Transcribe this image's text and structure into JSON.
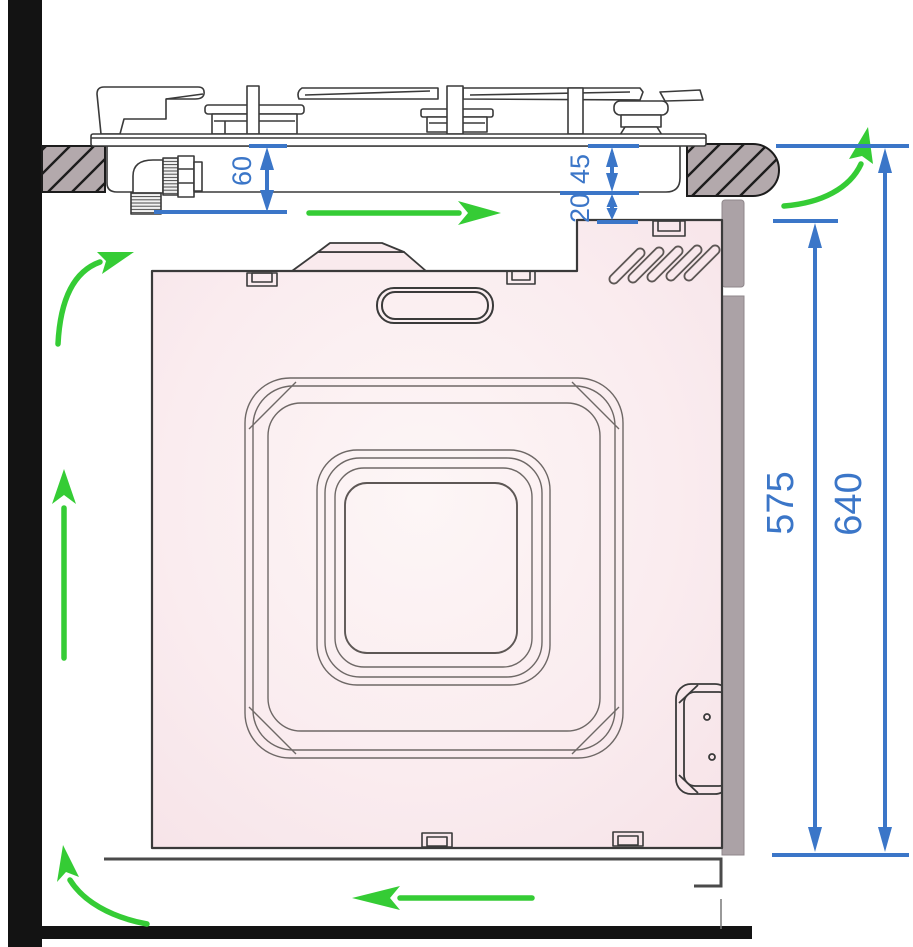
{
  "diagram": {
    "kind": "built-in oven and gas hob installation cross-section",
    "units": "mm"
  },
  "dimensions": {
    "hob_connection_depth": {
      "value": "60"
    },
    "hob_body_height": {
      "value": "45"
    },
    "ventilation_gap": {
      "value": "20"
    },
    "oven_niche_height": {
      "value": "575"
    },
    "overall_height": {
      "value": "640"
    }
  },
  "airflow": {
    "icons": [
      "airflow-curve-up-left-icon",
      "airflow-up-left-icon",
      "airflow-right-under-hob-icon",
      "airflow-curve-up-right-icon",
      "airflow-curve-bottom-left-icon",
      "airflow-left-under-oven-icon"
    ]
  },
  "colors": {
    "dimension_blue": "#3b76c8",
    "airflow_green": "#35cc35",
    "oven_body_pink": "#f8e6ea",
    "worktop_gray": "#b3a9ac",
    "cabinet_panel_gray": "#aba2a6",
    "wall_black": "#131313",
    "line_dark": "#3a3a3a"
  }
}
